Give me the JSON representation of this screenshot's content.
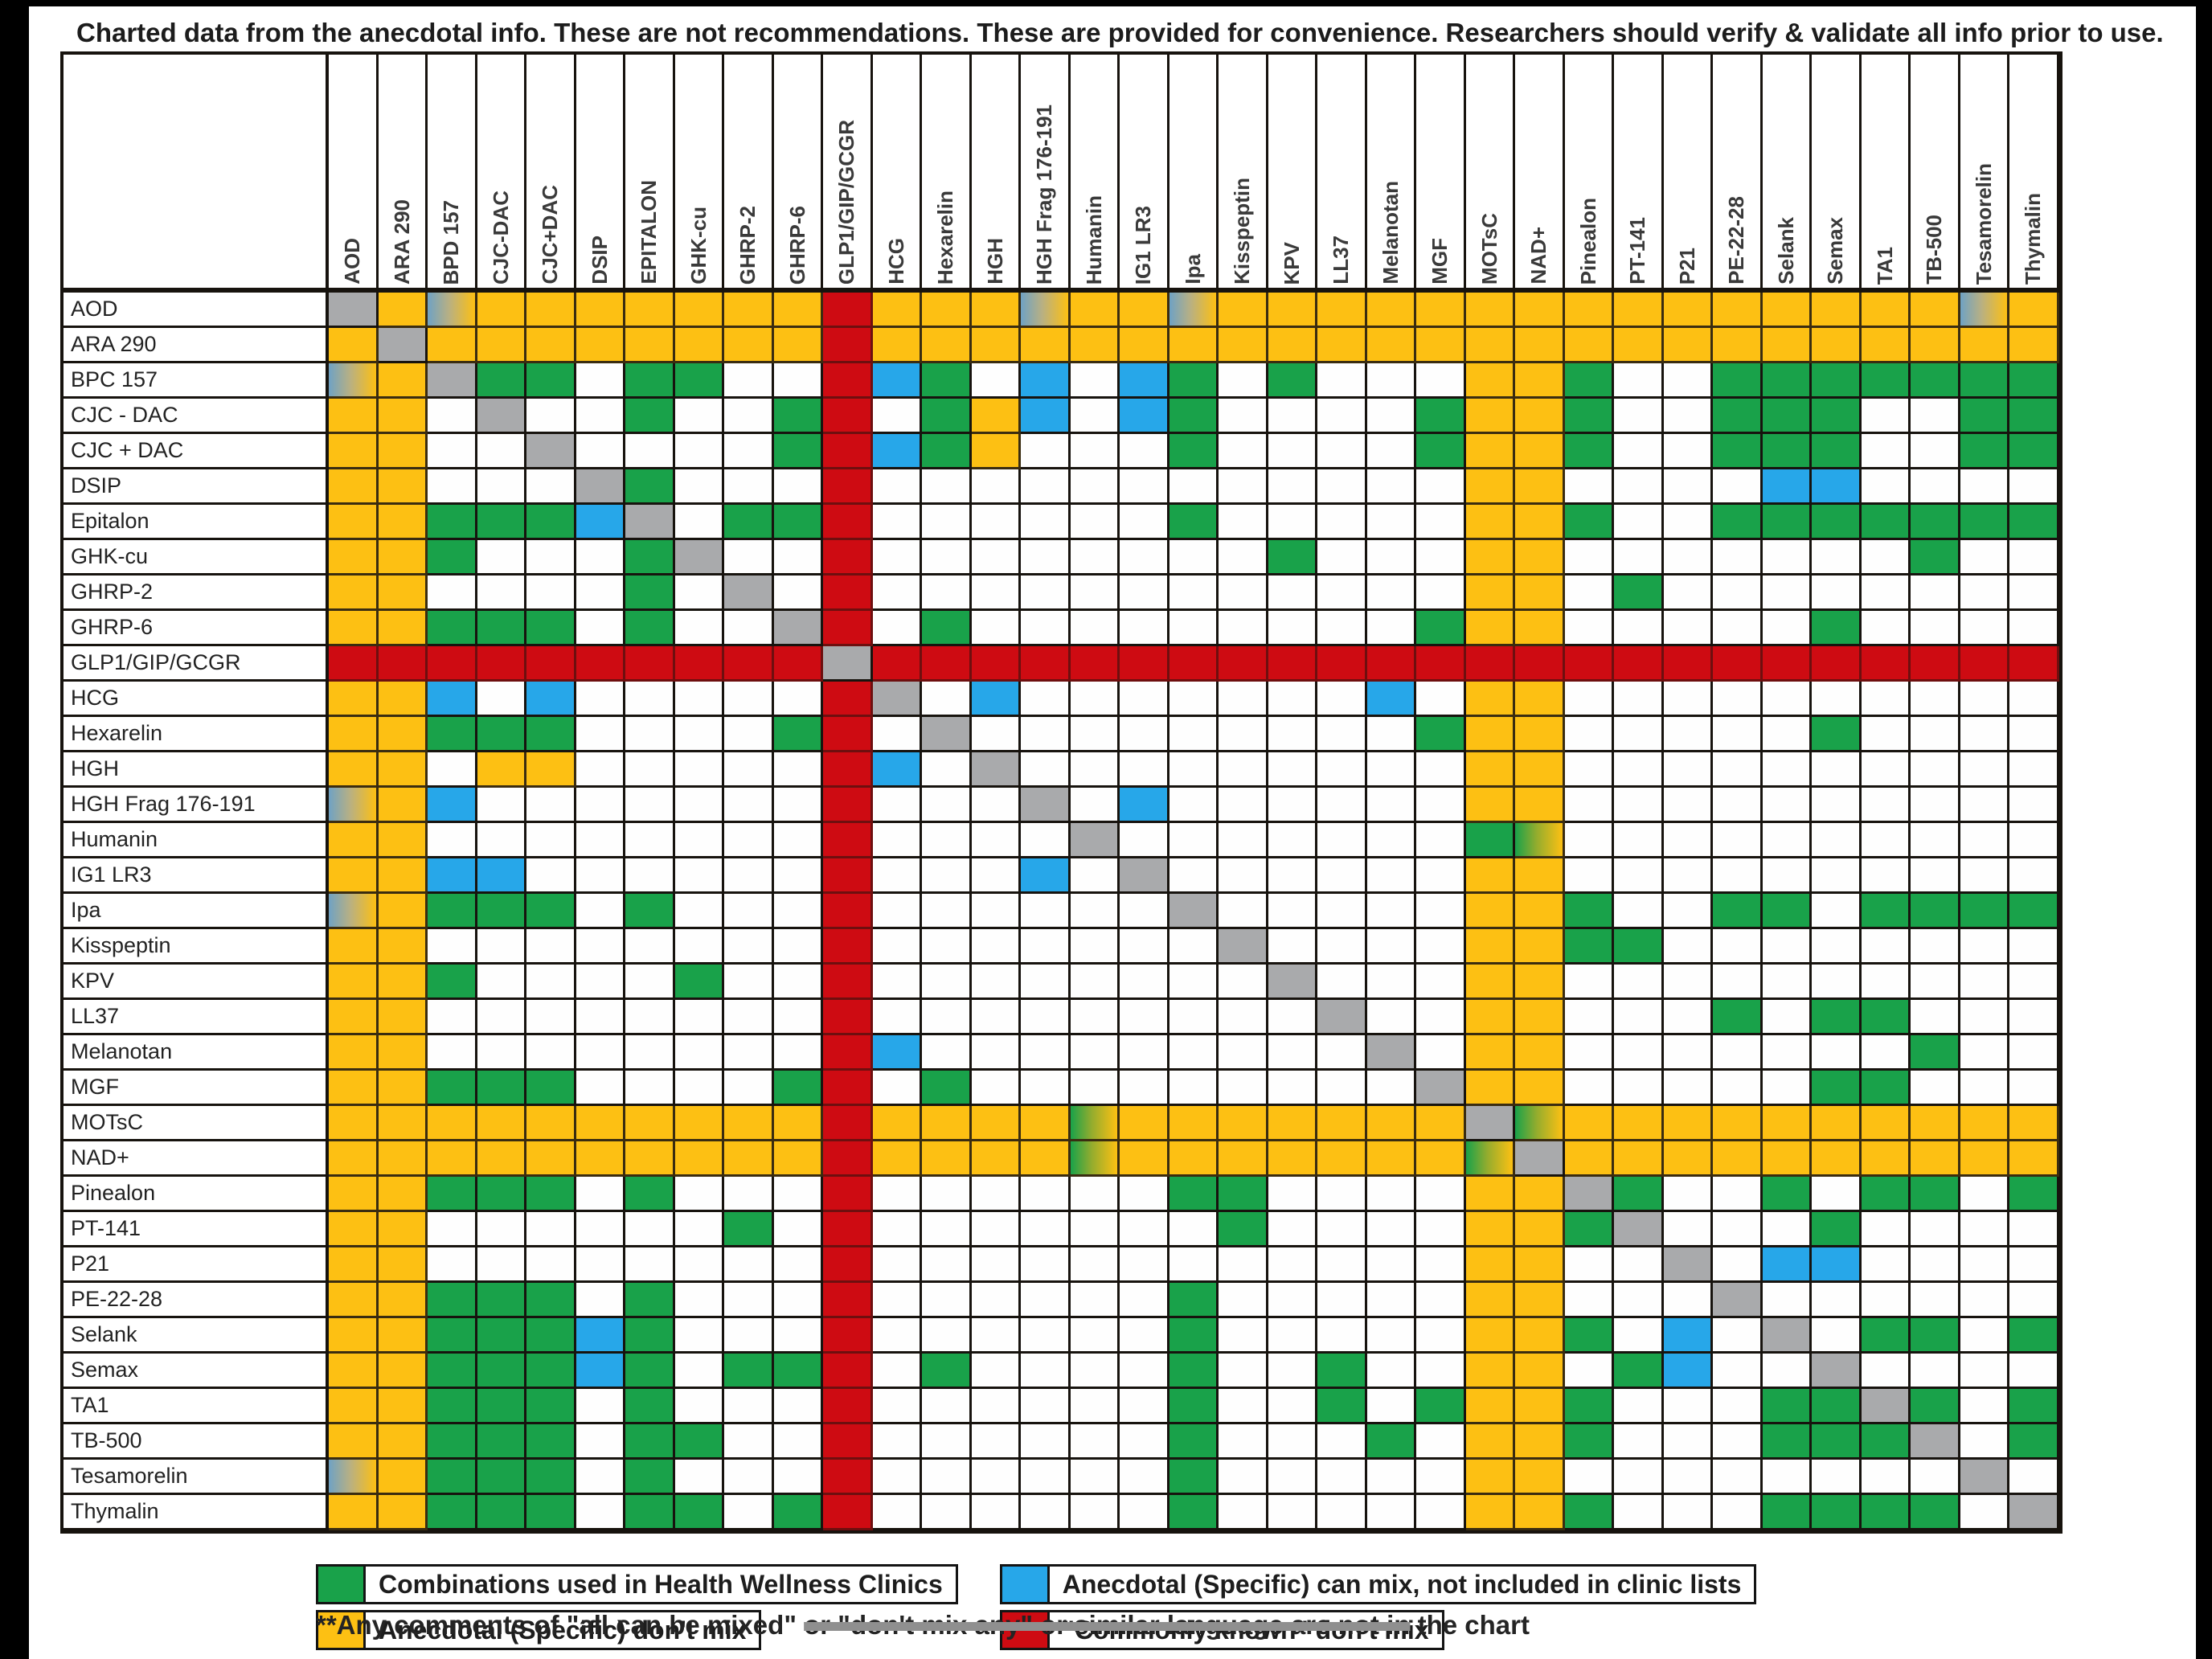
{
  "title": "Charted data from the anecdotal info. These are not recommendations. These are provided for convenience. Researchers should verify & validate all info prior to use.",
  "colors": {
    "G": "#19a24a",
    "Y": "#fdc013",
    "B": "#27a7e9",
    "R": "#ce0b12",
    "X": "#a9aaac",
    "W": "#fefefe"
  },
  "chart_data": {
    "type": "heatmap",
    "title": "Peptide mixing compatibility matrix",
    "legend_position": "bottom",
    "cell_codes": {
      "W": "blank / no data",
      "G": "Combinations used in Health Wellness Clinics",
      "Y": "Anecdotal (Specific) don't mix",
      "B": "Anecdotal (Specific) can mix, not included in clinic lists",
      "R": "\"Commonly known\" don't mix",
      "X": "self intersection (gray diagonal)",
      "U": "gradient blue-to-yellow (mixed anecdotes)",
      "V": "gradient green-to-yellow (mixed anecdotes)"
    },
    "columns": [
      "AOD",
      "ARA 290",
      "BPD 157",
      "CJC-DAC",
      "CJC+DAC",
      "DSIP",
      "EPITALON",
      "GHK-cu",
      "GHRP-2",
      "GHRP-6",
      "GLP1/GIP/GCGR",
      "HCG",
      "Hexarelin",
      "HGH",
      "HGH Frag 176-191",
      "Humanin",
      "IG1 LR3",
      "Ipa",
      "Kisspeptin",
      "KPV",
      "LL37",
      "Melanotan",
      "MGF",
      "MOTsC",
      "NAD+",
      "Pinealon",
      "PT-141",
      "P21",
      "PE-22-28",
      "Selank",
      "Semax",
      "TA1",
      "TB-500",
      "Tesamorelin",
      "Thymalin"
    ],
    "rows": [
      "AOD",
      "ARA 290",
      "BPC 157",
      "CJC - DAC",
      "CJC + DAC",
      "DSIP",
      "Epitalon",
      "GHK-cu",
      "GHRP-2",
      "GHRP-6",
      "GLP1/GIP/GCGR",
      "HCG",
      "Hexarelin",
      "HGH",
      "HGH Frag 176-191",
      "Humanin",
      "IG1 LR3",
      "Ipa",
      "Kisspeptin",
      "KPV",
      "LL37",
      "Melanotan",
      "MGF",
      "MOTsC",
      "NAD+",
      "Pinealon",
      "PT-141",
      "P21",
      "PE-22-28",
      "Selank",
      "Semax",
      "TA1",
      "TB-500",
      "Tesamorelin",
      "Thymalin"
    ],
    "matrix": [
      "XYUYYYYYYYRYYYUYYUYYYYYYYYYYYYYYYUY",
      "YXYYYYYYYYRYYYYYYYYYYYYYYYYYYYYYYYY",
      "UYXGGWGGWWRBGWBWBGWGWWWYYGWWGGGGGGG",
      "YYWXWWGWWGRWGYBWBGWWWWGYYGWWGGGWWGG",
      "YYWWXWWWWGRBGYWWWGWWWWGYYGWWGGGWWGG",
      "YYWWWXGWWWRWWWWWWWWWWWWYYWWWWBBWWWW",
      "YYGGGBXWGGRWWWWWWGWWWWWYYGWWGGGGGGG",
      "YYGWWWGXWWRWWWWWWWWGWWWYYWWWWWWWGWW",
      "YYWWWWGWXWRWWWWWWWWWWWWYYWGWWWWWWWW",
      "YYGGGWGWWXRWGWWWWWWWWWGYYWWWWWGWWWW",
      "RRRRRRRRRRXRRRRRRRRRRRRRRRRRRRRRRRR",
      "YYBWBWWWWWRXWBWWWWWWWBWYYWWWWWWWWWW",
      "YYGGGWWWWGRWXWWWWWWWWWGYYWWWWWGWWWW",
      "YYWYYWWWWWRBWXWWWWWWWWWYYWWWWWWWWWW",
      "UYBWWWWWWWRWWWXWBWWWWWWYYWWWWWWWWWW",
      "YYWWWWWWWWRWWWWXWWWWWWWGVWWWWWWWWWW",
      "YYBBWWWWWWRWWWBWXWWWWWWYYWWWWWWWWWW",
      "UYGGGWGWWWRWWWWWWXWWWWWYYGWWGGWGGGG",
      "YYWWWWWWWWRWWWWWWWXWWWWYYGGWWWWWWWW",
      "YYGWWWWGWWRWWWWWWWWXWWWYYWWWWWWWWWW",
      "YYWWWWWWWWRWWWWWWWWWXWWYYWWWGWGGWWW",
      "YYWWWWWWWWRBWWWWWWWWWXWYYWWWWWWWGWW",
      "YYGGGWWWWGRWGWWWWWWWWWXYYWWWWWGGWWW",
      "YYYYYYYYYYRYYYYVYYYYYYYXVYYYYYYYYYY",
      "YYYYYYYYYYRYYYYVYYYYYYYVXYYYYYYYYYY",
      "YYGGGWGWWWRWWWWWWGGWWWWYYXGWWGWGGWG",
      "YYWWWWWWGWRWWWWWWWGWWWWYYGXWWWGWWWW",
      "YYWWWWWWWWRWWWWWWWWWWWWYYWWXWBBWWWW",
      "YYGGGWGWWWRWWWWWWGWWWWWYYWWWXWWWWWW",
      "YYGGGBGWWWRWWWWWWGWWWWWYYGWBWXWGGWG",
      "YYGGGBGWGGRWGWWWWGWWGWWYYWGBWWXWWWW",
      "YYGGGWGWWWRWWWWWWGWWGWGYYGWWWGGXGWG",
      "YYGGGWGGWWRWWWWWWGWWWGWYYGWWWGGGXWG",
      "UYGGGWGWWWRWWWWWWGWWWWWYYWWWWWWWWXW",
      "YYGGGWGGWGRWWWWWWGWWWWWYYGWWWGGGGWX"
    ]
  },
  "legend": [
    {
      "code": "G",
      "label": "Combinations used in Health Wellness Clinics"
    },
    {
      "code": "Y",
      "label": "Anecdotal (Specific) don't mix"
    },
    {
      "code": "B",
      "label": "Anecdotal (Specific) can mix, not included in clinic lists"
    },
    {
      "code": "R",
      "label": "\"Commonly known\" don't mix"
    }
  ],
  "footnote": {
    "prefix": "**Any comments of \"all can be mixed\" ",
    "struck": "or \"don't mix any\" or similar language are not in",
    "suffix": " the chart"
  }
}
